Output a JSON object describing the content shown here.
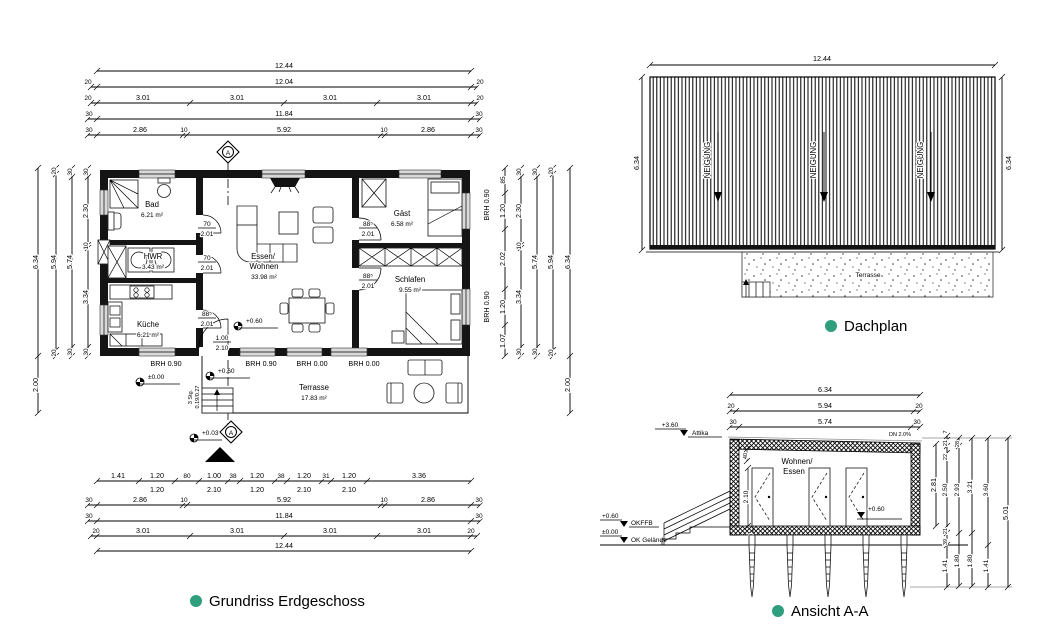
{
  "accent_color": "#2e9e7d",
  "titles": {
    "plan": "Grundriss Erdgeschoss",
    "roof": "Dachplan",
    "section": "Ansicht A-A"
  },
  "plan": {
    "top": {
      "r1": [
        "12.44"
      ],
      "r2": [
        "20",
        "12.04",
        "20"
      ],
      "r3": [
        "20",
        "3.01",
        "3.01",
        "3.01",
        "3.01",
        "20"
      ],
      "r4": [
        "30",
        "11.84",
        "30"
      ],
      "r5": [
        "30",
        "2.86",
        "10",
        "5.92",
        "10",
        "2.86",
        "30"
      ]
    },
    "bottom": {
      "r1": [
        "1.41",
        "1.20",
        "80",
        "1.00",
        "38",
        "1.20",
        "38",
        "1.20",
        "31",
        "1.20",
        "3.36"
      ],
      "r1b": [
        "1.20",
        "2.10",
        "1.20",
        "2.10",
        "2.10"
      ],
      "r2": [
        "30",
        "2.86",
        "10",
        "5.92",
        "10",
        "2.86",
        "30"
      ],
      "r3": [
        "30",
        "11.84",
        "30"
      ],
      "r4": [
        "20",
        "3.01",
        "3.01",
        "3.01",
        "3.01",
        "20"
      ],
      "r5": [
        "12.44"
      ]
    },
    "left": {
      "c1": [
        "6.34",
        "2.00"
      ],
      "c2": [
        "20",
        "5.94",
        "20"
      ],
      "c3": [
        "30",
        "5.74",
        "30"
      ],
      "c4": [
        "30",
        "2.30",
        "10",
        "3.34",
        "30"
      ]
    },
    "right": {
      "c1": [
        "85",
        "1.20",
        "2.02",
        "1.20",
        "1.07"
      ],
      "c2": [
        "30",
        "2.30",
        "10",
        "3.34",
        "30"
      ],
      "c3": [
        "30",
        "5.74",
        "30"
      ],
      "c4": [
        "20",
        "5.94",
        "20"
      ],
      "c5": [
        "6.34",
        "2.00"
      ],
      "brh": [
        "BRH 0.90",
        "BRH 0.90"
      ]
    },
    "rooms": {
      "bad": [
        "Bad",
        "6.21 m²"
      ],
      "hwr": [
        "HWR",
        "3.43 m²"
      ],
      "kueche": [
        "Küche",
        "6.21 m²"
      ],
      "wohnen": [
        "Essen/",
        "Wohnen",
        "33.98 m²"
      ],
      "gast": [
        "Gäst",
        "6.58 m²"
      ],
      "schlafen": [
        "Schlafen",
        "9.55 m²"
      ],
      "terrasse": [
        "Terrasse",
        "17.83 m²"
      ]
    },
    "doors": {
      "bad": [
        "70",
        "2.01"
      ],
      "hwr": [
        "70",
        "2.01"
      ],
      "kueche": [
        "88⁵",
        "2.01"
      ],
      "gast": [
        "88⁵",
        "2.01"
      ],
      "schlafen": [
        "88⁵",
        "2.01"
      ],
      "terrasse": [
        "1.00",
        "2.10"
      ]
    },
    "levels": {
      "living": "+0.60",
      "entry": "+0.60",
      "ground": "±0.00",
      "outside": "+0.03"
    },
    "stairs": [
      "3 Stg.",
      "0.19/0.27"
    ],
    "brh_row": [
      "BRH 0.90",
      "BRH 0.90",
      "BRH 0.00",
      "BRH 0.00"
    ],
    "marker": "A"
  },
  "roof": {
    "dim_top": "12.44",
    "dim_left": "6.34",
    "dim_right": "6.34",
    "slopes": [
      "NEIGUNG",
      "NEIGUNG",
      "NEIGUNG"
    ],
    "terrace": "Terrasse"
  },
  "section": {
    "top": {
      "r1": [
        "6.34"
      ],
      "r2": [
        "20",
        "5.94",
        "20"
      ],
      "r3": [
        "30",
        "5.74",
        "30"
      ]
    },
    "attika": [
      "+3.60",
      "Attika"
    ],
    "okffb": [
      "+0.60",
      "OKFFB"
    ],
    "gelaende": [
      "±0.00",
      "OK Gelände"
    ],
    "slope_note": "DN 2.0%",
    "room": [
      "Wohnen/",
      "Essen"
    ],
    "inner": {
      "roof": "40",
      "door": "2.10",
      "floor": "60",
      "level": "+0.60"
    },
    "right": {
      "c1": [
        "2.81"
      ],
      "c2": [
        "7",
        "21",
        "22",
        "2.50",
        "21",
        "39",
        "1.41"
      ],
      "c3": [
        "28",
        "2.93",
        "1.80"
      ],
      "c4": [
        "3.21",
        "1.80"
      ],
      "c5": [
        "3.60",
        "1.41"
      ],
      "c6": [
        "5.01"
      ]
    }
  }
}
